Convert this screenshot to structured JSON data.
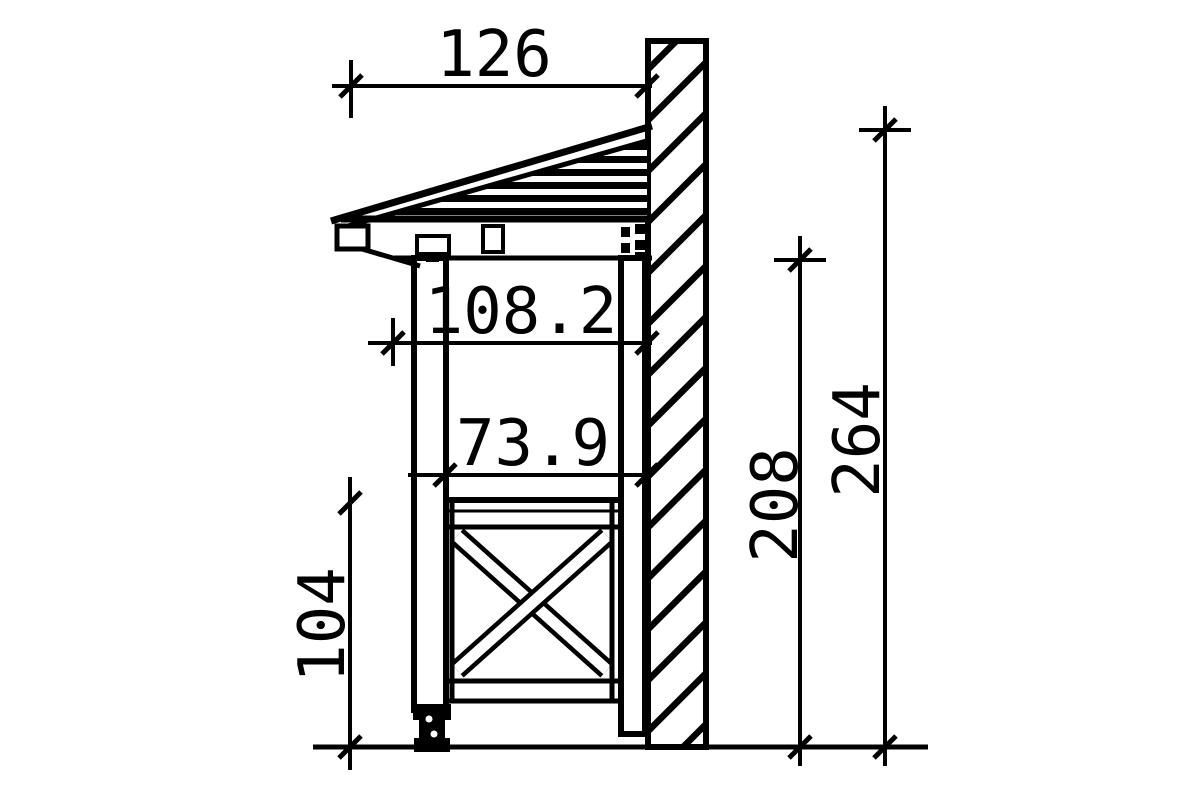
{
  "drawing": {
    "kind": "technical-side-elevation",
    "subject": "wall-mounted canopy with cross-braced side panel",
    "background_color": "#ffffff",
    "line_color": "#000000",
    "dimensions": [
      {
        "id": "roof-depth",
        "value": "126",
        "orientation": "horizontal",
        "position": "top"
      },
      {
        "id": "canopy-projection",
        "value": "108.2",
        "orientation": "horizontal",
        "position": "upper-middle"
      },
      {
        "id": "post-to-wall",
        "value": "73.9",
        "orientation": "horizontal",
        "position": "middle"
      },
      {
        "id": "railing-height",
        "value": "104",
        "orientation": "vertical",
        "position": "left"
      },
      {
        "id": "clear-height",
        "value": "208",
        "orientation": "vertical",
        "position": "right-inner"
      },
      {
        "id": "total-height",
        "value": "264",
        "orientation": "vertical",
        "position": "right-outer"
      }
    ]
  }
}
